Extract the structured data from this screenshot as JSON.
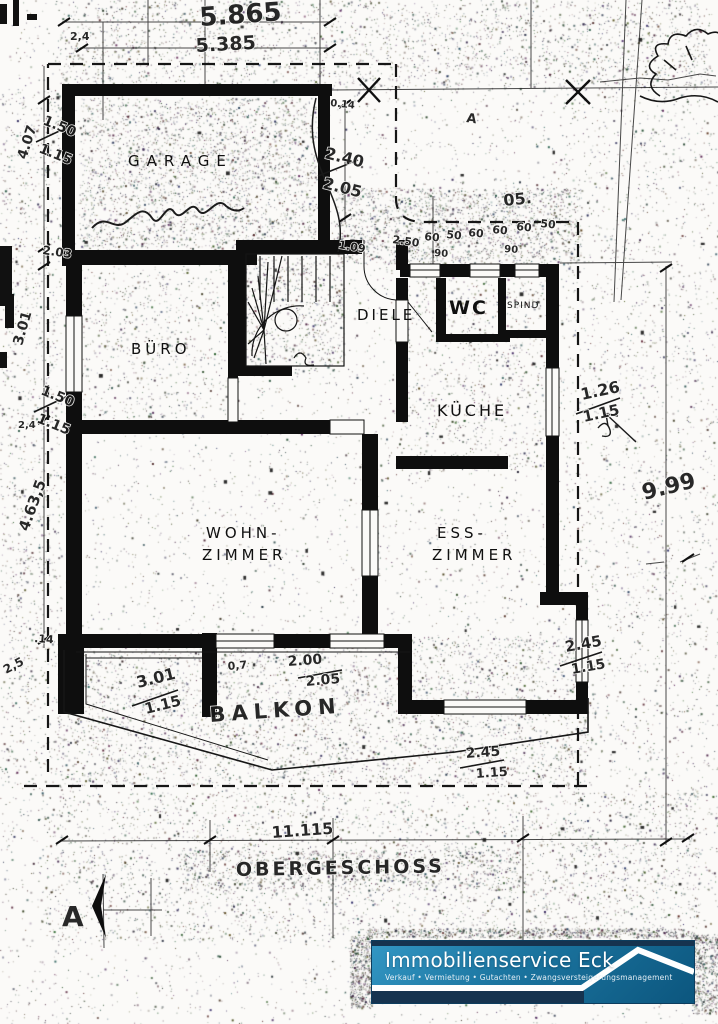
{
  "rooms": [
    {
      "label": "GARAGE",
      "x": 128,
      "y": 166,
      "size": 15,
      "ls": 7
    },
    {
      "label": "BÜRO",
      "x": 131,
      "y": 354,
      "size": 15,
      "ls": 4
    },
    {
      "label": "DIELE",
      "x": 357,
      "y": 320,
      "size": 15,
      "ls": 3
    },
    {
      "label": "WC",
      "x": 449,
      "y": 314,
      "size": 19,
      "ls": 2,
      "bold": true
    },
    {
      "label": "SPIND",
      "x": 507,
      "y": 308,
      "size": 9,
      "ls": 1
    },
    {
      "label": "KÜCHE",
      "x": 437,
      "y": 416,
      "size": 16,
      "ls": 3
    },
    {
      "label": "WOHN-",
      "x": 206,
      "y": 538,
      "size": 15,
      "ls": 4
    },
    {
      "label": "ZIMMER",
      "x": 202,
      "y": 560,
      "size": 15,
      "ls": 4
    },
    {
      "label": "ESS-",
      "x": 437,
      "y": 538,
      "size": 15,
      "ls": 4
    },
    {
      "label": "ZIMMER",
      "x": 432,
      "y": 560,
      "size": 15,
      "ls": 4
    }
  ],
  "annotations": [
    {
      "t": "5.865",
      "x": 200,
      "y": 26,
      "r": -4,
      "s": 26
    },
    {
      "t": "2,4",
      "x": 70,
      "y": 40,
      "r": 0,
      "s": 11
    },
    {
      "t": "5.385",
      "x": 196,
      "y": 52,
      "r": -3,
      "s": 19
    },
    {
      "t": "4.07",
      "x": 26,
      "y": 160,
      "r": -72,
      "s": 14
    },
    {
      "t": "1.50",
      "x": 42,
      "y": 124,
      "r": 22,
      "s": 14
    },
    {
      "t": "1.15",
      "x": 38,
      "y": 152,
      "r": 22,
      "s": 14
    },
    {
      "t": "2.40",
      "x": 324,
      "y": 158,
      "r": 14,
      "s": 16
    },
    {
      "t": "2.05",
      "x": 322,
      "y": 188,
      "r": 14,
      "s": 16
    },
    {
      "t": "0.14",
      "x": 330,
      "y": 106,
      "r": 6,
      "s": 10
    },
    {
      "t": "A",
      "x": 466,
      "y": 122,
      "r": 8,
      "s": 13
    },
    {
      "t": "05.",
      "x": 504,
      "y": 206,
      "r": -6,
      "s": 16
    },
    {
      "t": "1.09",
      "x": 338,
      "y": 248,
      "r": 10,
      "s": 11
    },
    {
      "t": "2.50",
      "x": 392,
      "y": 243,
      "r": 8,
      "s": 11
    },
    {
      "t": "60",
      "x": 424,
      "y": 240,
      "r": 6,
      "s": 11
    },
    {
      "t": "50",
      "x": 446,
      "y": 238,
      "r": 6,
      "s": 11
    },
    {
      "t": "60",
      "x": 468,
      "y": 236,
      "r": 6,
      "s": 11
    },
    {
      "t": "60",
      "x": 492,
      "y": 233,
      "r": 6,
      "s": 11
    },
    {
      "t": "60",
      "x": 516,
      "y": 230,
      "r": 6,
      "s": 11
    },
    {
      "t": "50",
      "x": 540,
      "y": 227,
      "r": 6,
      "s": 11
    },
    {
      "t": "90",
      "x": 434,
      "y": 256,
      "r": 4,
      "s": 10
    },
    {
      "t": "90",
      "x": 504,
      "y": 252,
      "r": 4,
      "s": 10
    },
    {
      "t": "2.03",
      "x": 42,
      "y": 254,
      "r": 8,
      "s": 12
    },
    {
      "t": "3.01",
      "x": 22,
      "y": 346,
      "r": -74,
      "s": 14
    },
    {
      "t": "1.50",
      "x": 40,
      "y": 394,
      "r": 22,
      "s": 14
    },
    {
      "t": "1.15",
      "x": 36,
      "y": 422,
      "r": 22,
      "s": 14
    },
    {
      "t": "2,4",
      "x": 18,
      "y": 428,
      "r": 0,
      "s": 10
    },
    {
      "t": "4.63,5",
      "x": 28,
      "y": 532,
      "r": -70,
      "s": 15
    },
    {
      "t": ".14",
      "x": 34,
      "y": 642,
      "r": 4,
      "s": 11
    },
    {
      "t": "2,5",
      "x": 6,
      "y": 674,
      "r": -28,
      "s": 12
    },
    {
      "t": "1.26",
      "x": 582,
      "y": 400,
      "r": -12,
      "s": 16
    },
    {
      "t": "1.15",
      "x": 584,
      "y": 422,
      "r": -12,
      "s": 15
    },
    {
      "t": "9.99",
      "x": 644,
      "y": 500,
      "r": -14,
      "s": 22
    },
    {
      "t": "2.45",
      "x": 566,
      "y": 652,
      "r": -10,
      "s": 15
    },
    {
      "t": "1.15",
      "x": 572,
      "y": 674,
      "r": -10,
      "s": 14
    },
    {
      "t": "3.01",
      "x": 138,
      "y": 688,
      "r": -14,
      "s": 16
    },
    {
      "t": "1.15",
      "x": 146,
      "y": 714,
      "r": -14,
      "s": 15
    },
    {
      "t": "0,7",
      "x": 228,
      "y": 670,
      "r": -5,
      "s": 11
    },
    {
      "t": "2.00",
      "x": 288,
      "y": 666,
      "r": -4,
      "s": 14
    },
    {
      "t": "2.05",
      "x": 306,
      "y": 686,
      "r": -5,
      "s": 14
    },
    {
      "t": "BALKON",
      "x": 210,
      "y": 722,
      "r": -4,
      "s": 21,
      "ls": 6
    },
    {
      "t": "2.45",
      "x": 466,
      "y": 758,
      "r": -4,
      "s": 14
    },
    {
      "t": "1.15",
      "x": 476,
      "y": 778,
      "r": -4,
      "s": 13
    },
    {
      "t": "11.115",
      "x": 272,
      "y": 838,
      "r": -4,
      "s": 16
    },
    {
      "t": "OBERGESCHOSS",
      "x": 236,
      "y": 876,
      "r": -1,
      "s": 19,
      "ls": 3
    },
    {
      "t": "A",
      "x": 62,
      "y": 926,
      "r": 0,
      "s": 28,
      "b": true
    }
  ],
  "footer": {
    "title": "Immobilienservice Eck",
    "subtitle": "Verkauf • Vermietung • Gutachten • Zwangsversteigerungsmanagement"
  },
  "colors": {
    "banner_navy": "#16334f",
    "banner_teal_light": "#3397c4",
    "banner_teal_dark": "#0c567e",
    "roofline": "#ffffff",
    "ink": "#111111"
  }
}
